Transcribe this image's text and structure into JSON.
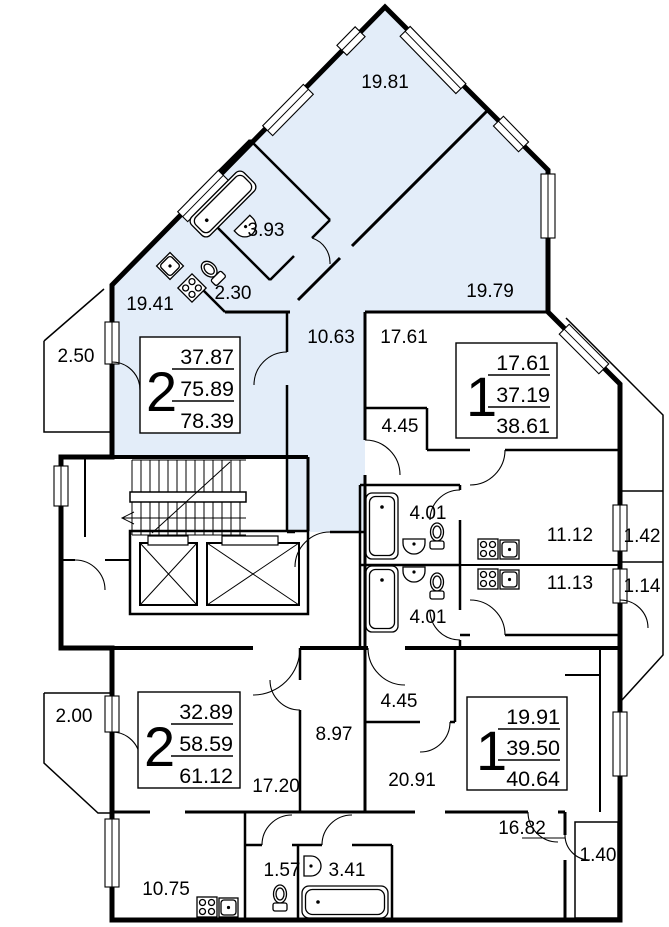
{
  "plan": {
    "title": "apartment-floor-plan",
    "colors": {
      "highlight_fill": "#e3edf9",
      "line": "#000000",
      "background": "#ffffff"
    },
    "apartments": [
      {
        "rooms": "2",
        "living": "37.87",
        "floor_area": "75.89",
        "total": "78.39"
      },
      {
        "rooms": "1",
        "living": "17.61",
        "floor_area": "37.19",
        "total": "38.61"
      },
      {
        "rooms": "2",
        "living": "32.89",
        "floor_area": "58.59",
        "total": "61.12"
      },
      {
        "rooms": "1",
        "living": "19.91",
        "floor_area": "39.50",
        "total": "40.64"
      }
    ],
    "rooms": {
      "r19_81": "19.81",
      "r19_79": "19.79",
      "r3_93": "3.93",
      "r2_30": "2.30",
      "r19_41": "19.41",
      "r10_63": "10.63",
      "r17_61": "17.61",
      "r2_50": "2.50",
      "r4_45_b": "4.45",
      "r4_01_1": "4.01",
      "r4_01_2": "4.01",
      "r11_12": "11.12",
      "r1_42": "1.42",
      "r11_13": "11.13",
      "r1_14": "1.14",
      "r2_00": "2.00",
      "r8_97": "8.97",
      "r17_20": "17.20",
      "r4_45_d": "4.45",
      "r20_91": "20.91",
      "r10_75": "10.75",
      "r1_57": "1.57",
      "r3_41": "3.41",
      "r16_82": "16.82",
      "r1_40": "1.40"
    }
  }
}
